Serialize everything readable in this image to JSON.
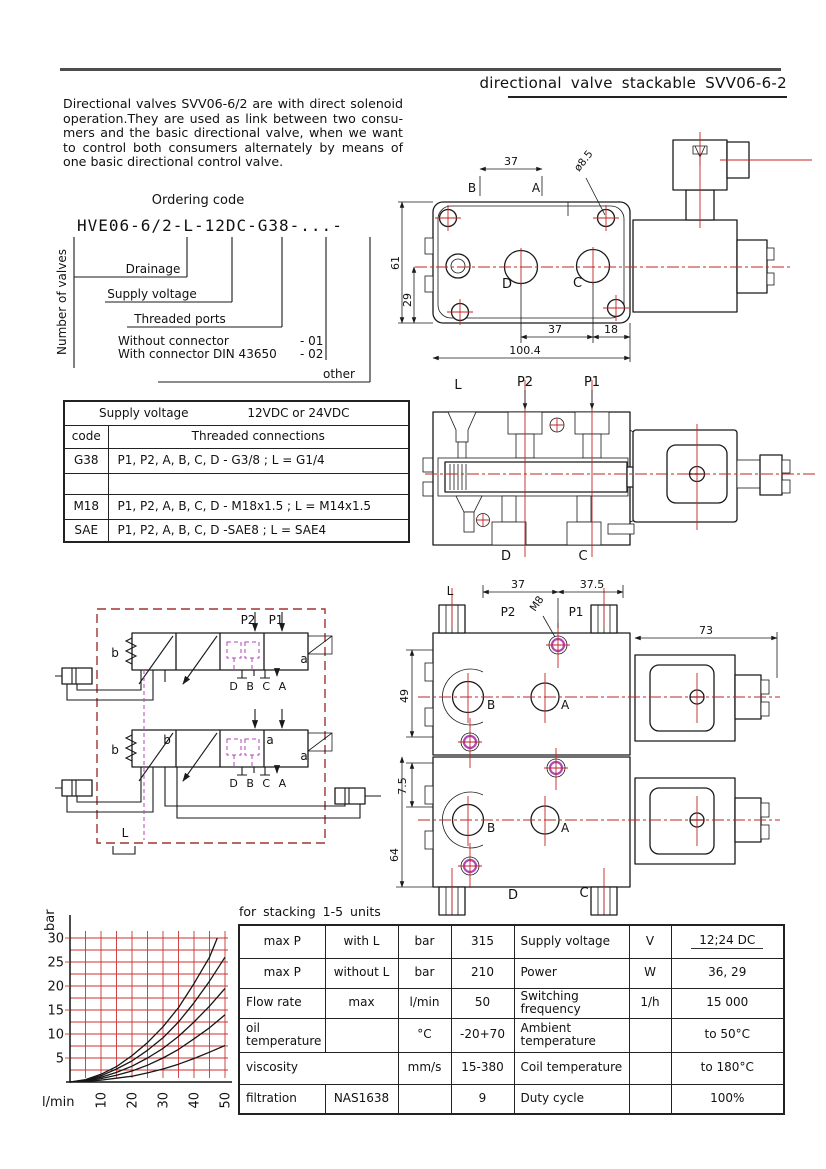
{
  "colors": {
    "accent_red": "#c22525",
    "hatch_magenta": "#d883d8",
    "spool_magenta": "#c24ac2",
    "schematic_box_red": "#a03434",
    "line_black": "#1a1a1a"
  },
  "header": {
    "title": "directional valve stackable SVV06-6-2"
  },
  "intro": {
    "lines": [
      "Directional valves SVV06-6/2 are with direct solenoid",
      "operation.They are used as link between two consu-",
      "mers and the basic directional valve, when we want",
      "to control both consumers alternately by means of",
      "one basic directional control valve."
    ]
  },
  "ordering": {
    "title": "Ordering code",
    "code": "HVE06-6/2-L-12DC-G38-...-",
    "number_of_valves": "Number of valves",
    "drainage": "Drainage",
    "supply_voltage": "Supply voltage",
    "threaded_ports": "Threaded ports",
    "without_connector": "Without connector",
    "without_code": "-  01",
    "with_connector": "With connector DIN 43650",
    "with_code": "-  02",
    "other": "other"
  },
  "table1": {
    "supply_label": "Supply voltage",
    "supply_value": "12VDC or 24VDC",
    "col_code": "code",
    "col_threaded": "Threaded connections",
    "rows": [
      [
        "G38",
        "P1, P2, A, B, C, D - G3/8 ; L = G1/4"
      ],
      [
        "",
        ""
      ],
      [
        "M18",
        "P1, P2, A, B, C, D - M18x1.5 ; L = M14x1.5"
      ],
      [
        "SAE",
        "P1, P2, A, B, C, D -SAE8 ; L = SAE4"
      ]
    ]
  },
  "drawing_top": {
    "d37_top": "37",
    "dia": "ø8.5",
    "b": "B",
    "a": "A",
    "d61": "61",
    "d29": "29",
    "port_d": "D",
    "port_c": "C",
    "d37_bot": "37",
    "d18": "18",
    "d100": "100.4"
  },
  "drawing_section": {
    "l": "L",
    "p2": "P2",
    "p1": "P1",
    "d": "D",
    "c": "C"
  },
  "schematic": {
    "p2": "P2",
    "p1": "P1",
    "b": "b",
    "a": "a",
    "ports": "D B C A",
    "l": "L"
  },
  "drawing_stack": {
    "l": "L",
    "d37": "37",
    "d37_5": "37.5",
    "p2": "P2",
    "m8": "M8",
    "p1": "P1",
    "d73": "73",
    "d49": "49",
    "d7_5": "7.5",
    "d64": "64",
    "b": "B",
    "a": "A",
    "d": "D",
    "c": "C"
  },
  "stacking_note": "for stacking 1-5 units",
  "chart_data": {
    "type": "line",
    "title": "",
    "xlabel": "l/min",
    "ylabel": "bar",
    "xlim": [
      0,
      50
    ],
    "ylim": [
      0,
      32
    ],
    "xticks": [
      10,
      20,
      30,
      40,
      50
    ],
    "yticks": [
      5,
      10,
      15,
      20,
      25,
      30
    ],
    "grid": {
      "show": true,
      "color": "#c33",
      "x_step": 5,
      "y_step": 2.5
    },
    "legend": "none",
    "series": [
      {
        "name": "curve-1",
        "x": [
          0,
          5,
          10,
          15,
          20,
          25,
          30,
          35,
          40,
          45,
          47.5
        ],
        "y": [
          0,
          0.5,
          1.6,
          3.2,
          5.5,
          8.2,
          11.5,
          15.5,
          20.5,
          26,
          30
        ]
      },
      {
        "name": "curve-2",
        "x": [
          0,
          5,
          10,
          15,
          20,
          25,
          30,
          35,
          40,
          45,
          50
        ],
        "y": [
          0,
          0.4,
          1.3,
          2.7,
          4.4,
          6.6,
          9.2,
          12.5,
          16.5,
          21,
          26
        ]
      },
      {
        "name": "curve-3",
        "x": [
          0,
          5,
          10,
          15,
          20,
          25,
          30,
          35,
          40,
          45,
          50
        ],
        "y": [
          0,
          0.3,
          1.0,
          2.0,
          3.3,
          5.0,
          7.0,
          9.5,
          12.5,
          15.8,
          19.5
        ]
      },
      {
        "name": "curve-4",
        "x": [
          0,
          5,
          10,
          15,
          20,
          25,
          30,
          35,
          40,
          45,
          50
        ],
        "y": [
          0,
          0.2,
          0.7,
          1.4,
          2.3,
          3.5,
          5.0,
          6.8,
          9.0,
          11.3,
          14
        ]
      },
      {
        "name": "curve-5",
        "x": [
          0,
          5,
          10,
          15,
          20,
          25,
          30,
          35,
          40,
          45,
          50
        ],
        "y": [
          0,
          0.1,
          0.4,
          0.8,
          1.2,
          1.9,
          2.7,
          3.7,
          4.9,
          6.2,
          7.6
        ]
      }
    ]
  },
  "spec_table": {
    "rows": [
      [
        "max P",
        "with L",
        "bar",
        "315",
        "Supply voltage",
        "V",
        "12;24 DC"
      ],
      [
        "max P",
        "without L",
        "bar",
        "210",
        "Power",
        "W",
        "36, 29"
      ],
      [
        "Flow rate",
        "max",
        "l/min",
        "50",
        "Switching frequency",
        "1/h",
        "15 000"
      ],
      [
        "oil temperature",
        "",
        "°C",
        "-20+70",
        "Ambient temperature",
        "",
        "to 50°C"
      ],
      [
        "viscosity",
        "mm/s",
        "15-380",
        "Coil temperature",
        "",
        "to 180°C"
      ],
      [
        "filtration",
        "NAS1638",
        "",
        "9",
        "Duty cycle",
        "",
        "100%"
      ]
    ]
  }
}
